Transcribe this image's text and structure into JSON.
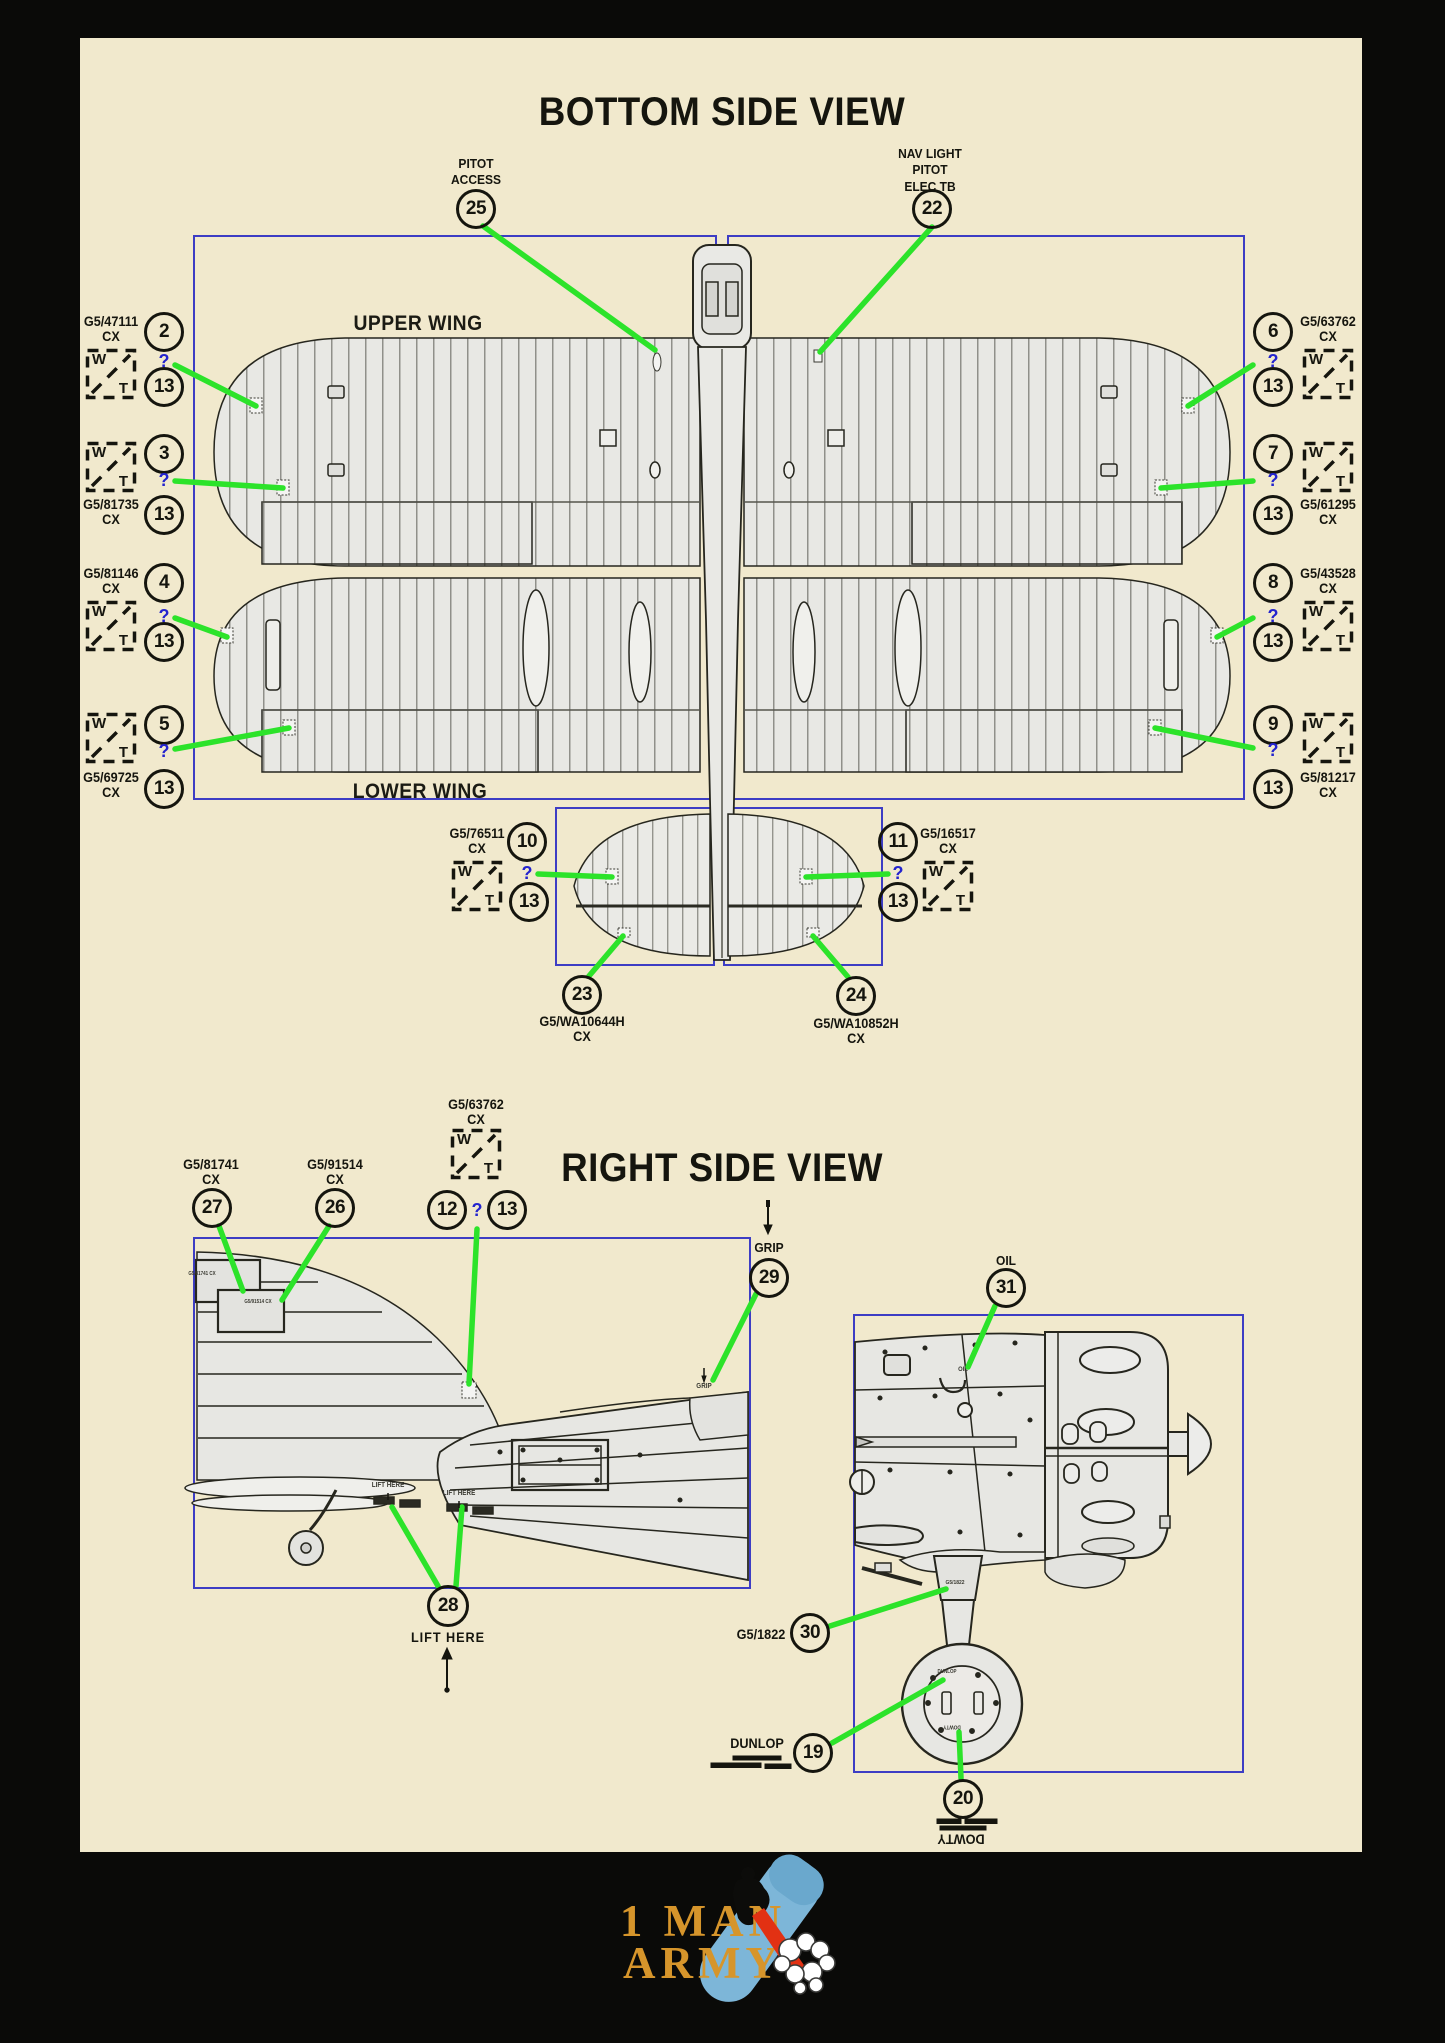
{
  "titles": {
    "bottom_view": "BOTTOM SIDE VIEW",
    "right_view": "RIGHT SIDE VIEW"
  },
  "wing_labels": {
    "upper": "UPPER WING",
    "lower": "LOWER WING"
  },
  "wt_icon": {
    "w": "W",
    "t": "T"
  },
  "query": "?",
  "colors": {
    "background": "#f1e9cd",
    "frame_blue": "#3d3dc4",
    "leader_green": "#2ce32a",
    "ink": "#15150e",
    "query_blue": "#2424ce",
    "logo_gold": "#d6952b",
    "logo_bomb_blue": "#7db6d8",
    "logo_flame_red": "#e23113"
  },
  "top_callouts": {
    "pitot_access": {
      "line1": "PITOT",
      "line2": "ACCESS",
      "num": "25"
    },
    "nav_light": {
      "line1": "NAV LIGHT",
      "line2": "PITOT",
      "line3": "ELEC TB",
      "num": "22"
    }
  },
  "side_callouts": {
    "a": {
      "code": "G5/47111",
      "cx": "CX",
      "num": "2",
      "mask": "13"
    },
    "b": {
      "code": "G5/81735",
      "cx": "CX",
      "num": "3",
      "mask": "13"
    },
    "c": {
      "code": "G5/81146",
      "cx": "CX",
      "num": "4",
      "mask": "13"
    },
    "d": {
      "code": "G5/69725",
      "cx": "CX",
      "num": "5",
      "mask": "13"
    },
    "e": {
      "code": "G5/63762",
      "cx": "CX",
      "num": "6",
      "mask": "13"
    },
    "f": {
      "code": "G5/61295",
      "cx": "CX",
      "num": "7",
      "mask": "13"
    },
    "g": {
      "code": "G5/43528",
      "cx": "CX",
      "num": "8",
      "mask": "13"
    },
    "h": {
      "code": "G5/81217",
      "cx": "CX",
      "num": "9",
      "mask": "13"
    }
  },
  "elevator_callouts": {
    "left": {
      "code": "G5/76511",
      "cx": "CX",
      "num": "10",
      "mask": "13"
    },
    "right": {
      "code": "G5/16517",
      "cx": "CX",
      "num": "11",
      "mask": "13"
    },
    "tab_left": {
      "num": "23",
      "code": "G5/WA10644H",
      "cx": "CX"
    },
    "tab_right": {
      "num": "24",
      "code": "G5/WA10852H",
      "cx": "CX"
    }
  },
  "right_view_callouts": {
    "walkway": {
      "code": "G5/63762",
      "cx": "CX",
      "num": "12",
      "mask": "13"
    },
    "panel27": {
      "code": "G5/81741",
      "cx": "CX",
      "num": "27"
    },
    "panel26": {
      "code": "G5/91514",
      "cx": "CX",
      "num": "26"
    },
    "grip": {
      "label": "GRIP",
      "num": "29"
    },
    "oil": {
      "label": "OIL",
      "num": "31"
    },
    "strut": {
      "code": "G5/1822",
      "num": "30"
    },
    "dunlop": {
      "label": "DUNLOP",
      "num": "19"
    },
    "dowty": {
      "label": "DOWTY",
      "num": "20"
    },
    "lift": {
      "label": "LIFT HERE",
      "num": "28"
    }
  },
  "in_drawing": {
    "lift_here_1": "LIFT HERE",
    "lift_here_2": "LIFT HERE",
    "grip": "GRIP",
    "oil": "OIL",
    "strut_code": "G5/1822",
    "hub_top": "DUNLOP",
    "hub_bottom": "DOWTY",
    "panel27_code": "G5/81741 CX",
    "panel26_code": "G5/91514 CX"
  },
  "logo": {
    "line1": "1 MAN",
    "line2": "ARMY"
  }
}
